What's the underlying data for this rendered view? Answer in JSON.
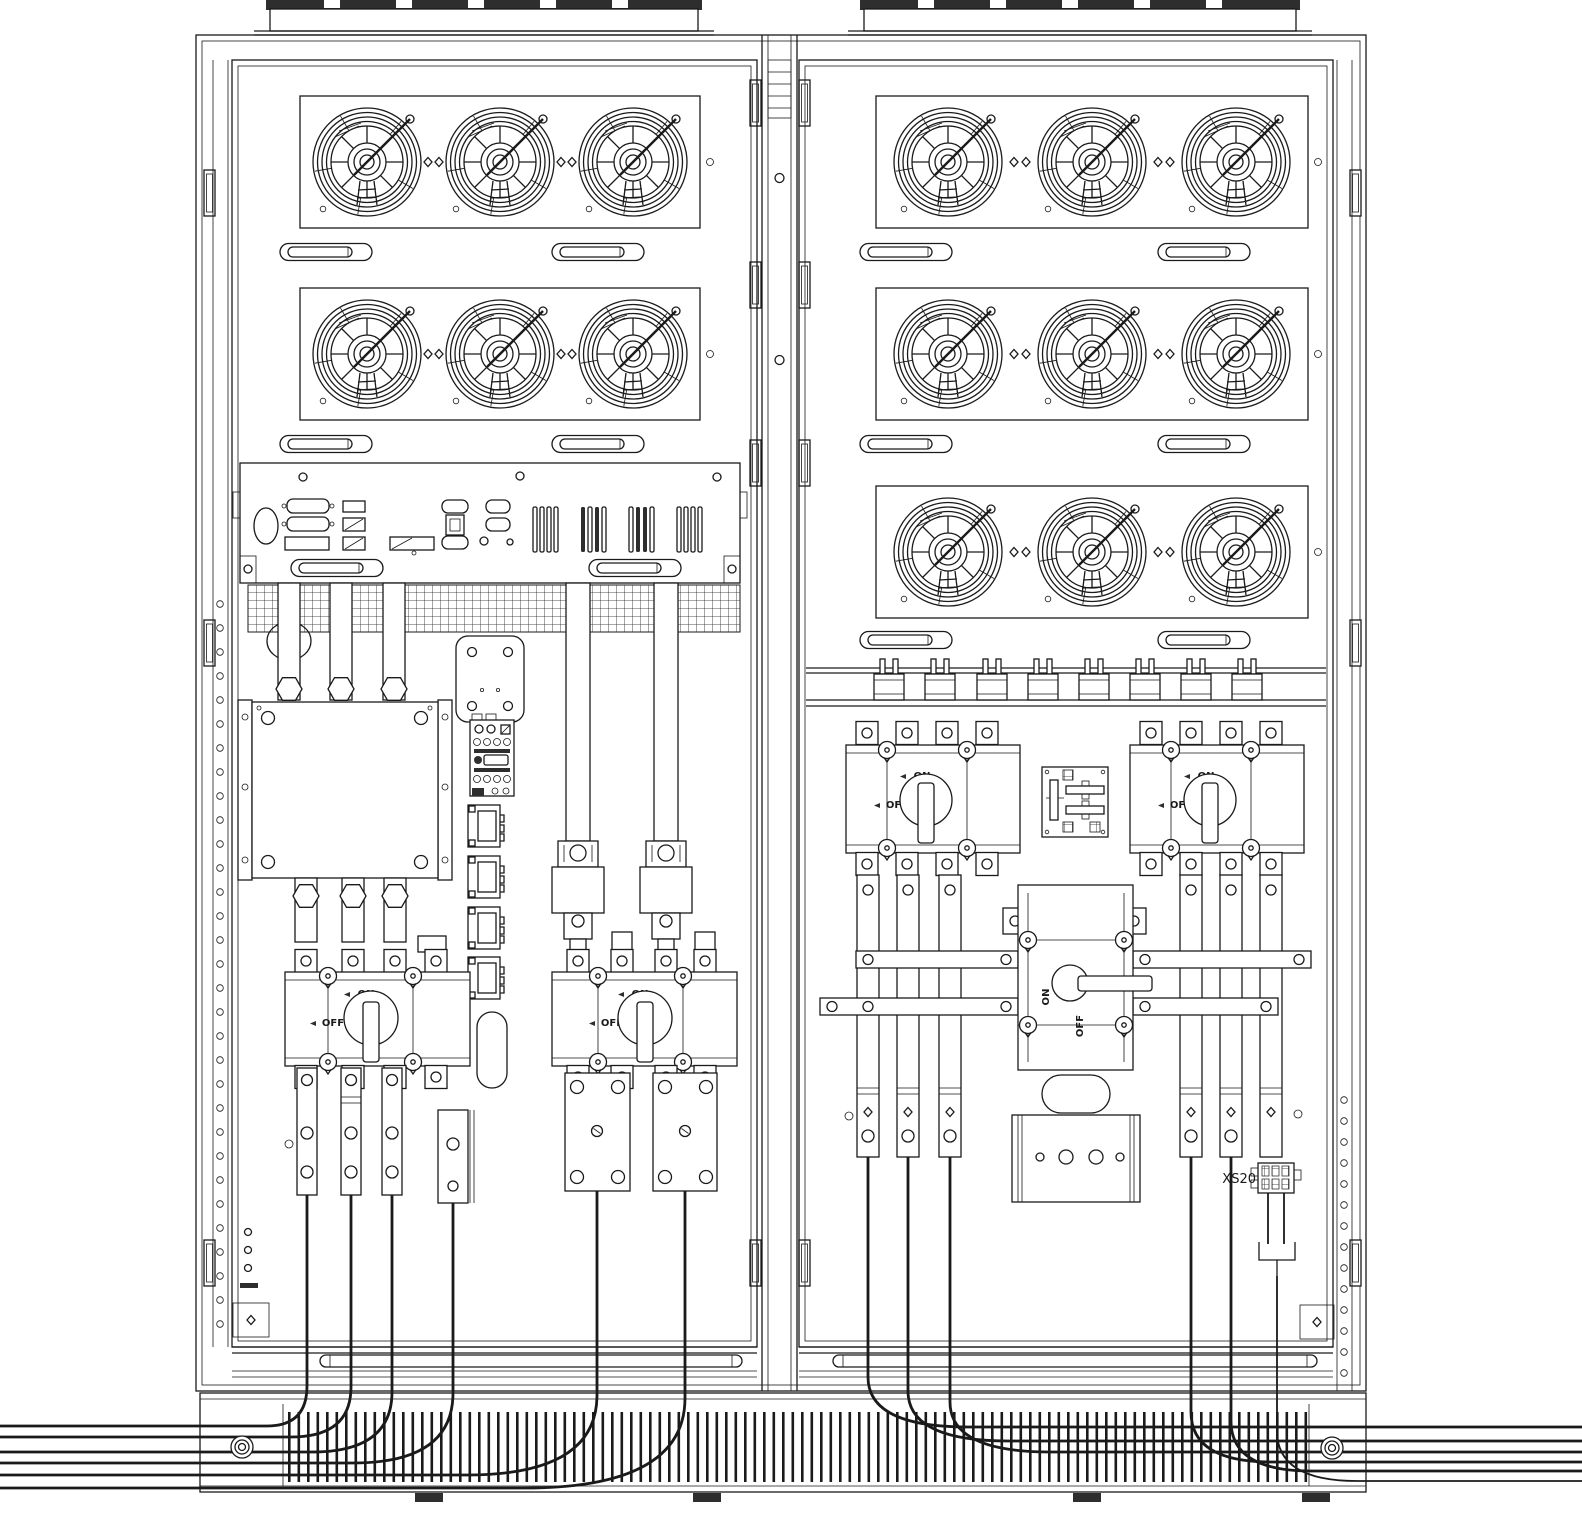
{
  "meta": {
    "type": "technical-line-drawing",
    "subject": "Dual-bay power cabinet, front internal view"
  },
  "colors": {
    "line": "#1a1a1a",
    "background": "#ffffff",
    "dark": "#2e2e2e"
  },
  "left_bay": {
    "fan_matrix": {
      "rows": 2,
      "cols": 3
    },
    "switch1": {
      "on": "ON",
      "off": "OFF"
    },
    "switch2": {
      "on": "ON",
      "off": "OFF"
    },
    "cables_exiting_left": 6
  },
  "right_bay": {
    "fan_matrix": {
      "rows": 3,
      "cols": 3
    },
    "switch_a": {
      "on": "ON",
      "off": "OFF"
    },
    "switch_b": {
      "on": "ON",
      "off": "OFF"
    },
    "bypass": {
      "on": "ON",
      "off": "OFF"
    },
    "connector": {
      "label": "XS20"
    },
    "cables_exiting_right": 6
  }
}
